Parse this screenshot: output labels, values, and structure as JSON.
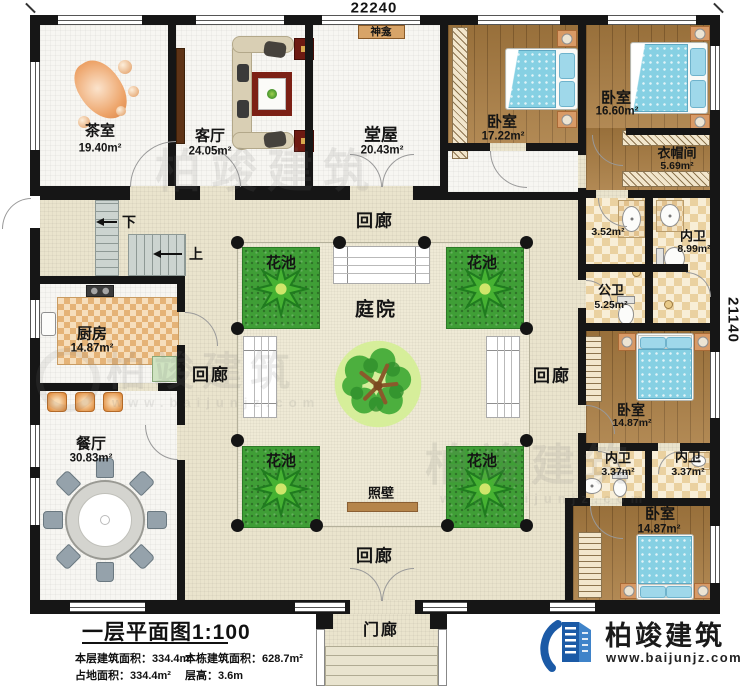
{
  "plan": {
    "dim_top": "22240",
    "dim_right": "21140"
  },
  "rooms": {
    "tea": {
      "name": "茶室",
      "area": "19.40m²"
    },
    "living": {
      "name": "客厅",
      "area": "24.05m²"
    },
    "shrine": {
      "name": "神龛"
    },
    "hall": {
      "name": "堂屋",
      "area": "20.43m²"
    },
    "bed1": {
      "name": "卧室",
      "area": "17.22m²"
    },
    "bed2": {
      "name": "卧室",
      "area": "16.60m²"
    },
    "cloak": {
      "name": "衣帽间",
      "area": "5.69m²"
    },
    "bathA": {
      "area": "3.52m²"
    },
    "ensuite1": {
      "name": "内卫",
      "area": "8.99m²"
    },
    "public_bath": {
      "name": "公卫",
      "area": "5.25m²"
    },
    "bed3": {
      "name": "卧室",
      "area": "14.87m²"
    },
    "ensuite2": {
      "name": "内卫",
      "area": "3.37m²"
    },
    "ensuite3": {
      "name": "内卫",
      "area": "3.37m²"
    },
    "bed4": {
      "name": "卧室",
      "area": "14.87m²"
    },
    "kitchen": {
      "name": "厨房",
      "area": "14.87m²"
    },
    "dining": {
      "name": "餐厅",
      "area": "30.83m²"
    },
    "courtyard": {
      "name": "庭院"
    },
    "screen_wall": {
      "name": "照壁"
    },
    "porch": {
      "name": "门廊"
    }
  },
  "corridors": {
    "top": "回廊",
    "left": "回廊",
    "right": "回廊",
    "bottom": "回廊"
  },
  "flower_beds": {
    "tl": "花池",
    "tr": "花池",
    "bl": "花池",
    "br": "花池"
  },
  "stairs": {
    "down": "下",
    "up": "上"
  },
  "title_block": {
    "title": "一层平面图1:100",
    "stats": [
      "本层建筑面积：334.4m²",
      "本栋建筑面积：628.7m²",
      "占地面积：334.4m²",
      "层高：3.6m"
    ]
  },
  "branding": {
    "company": "柏竣建筑",
    "website": "www.baijunjz.com"
  },
  "watermark": {
    "text": "柏竣建筑",
    "site": "www.baijunjz.com"
  },
  "colors": {
    "wall": "#161616",
    "wood": "#a97c41",
    "grass": "#3f9e36",
    "logo_blue": "#1b5aa6"
  }
}
